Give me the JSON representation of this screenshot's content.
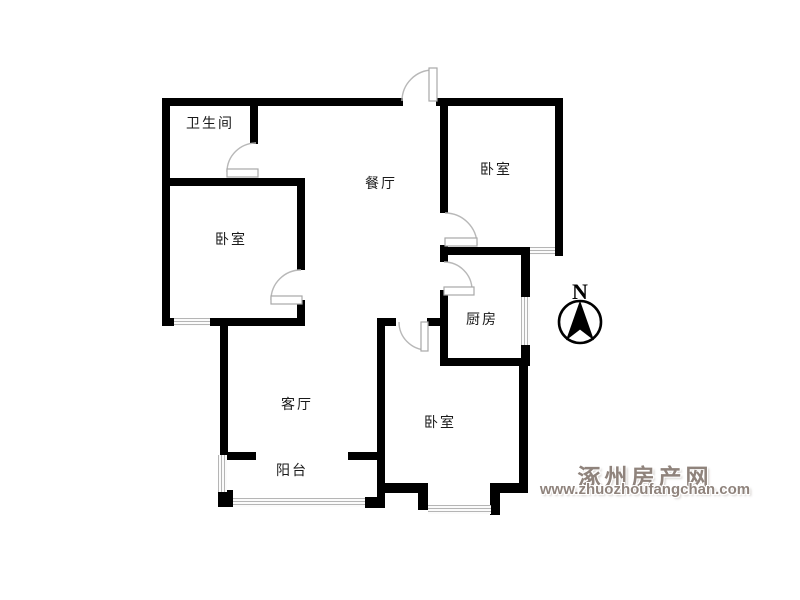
{
  "floorplan": {
    "rooms": [
      {
        "id": "bathroom",
        "label": "卫生间"
      },
      {
        "id": "dining",
        "label": "餐厅"
      },
      {
        "id": "bedroom-top-right",
        "label": "卧室"
      },
      {
        "id": "bedroom-left",
        "label": "卧室"
      },
      {
        "id": "kitchen",
        "label": "厨房"
      },
      {
        "id": "living-room",
        "label": "客厅"
      },
      {
        "id": "balcony",
        "label": "阳台"
      },
      {
        "id": "bedroom-bottom",
        "label": "卧室"
      }
    ],
    "compass": {
      "north_label": "N"
    },
    "colors": {
      "wall": "#000000",
      "door": "#b8b8b8",
      "window": "#b5b5b5",
      "label_text": "#1a1a1a",
      "watermark": "#8f837c"
    }
  },
  "watermark": {
    "site_name": "涿州房产网",
    "site_url": "www.zhuozhoufangchan.com"
  }
}
